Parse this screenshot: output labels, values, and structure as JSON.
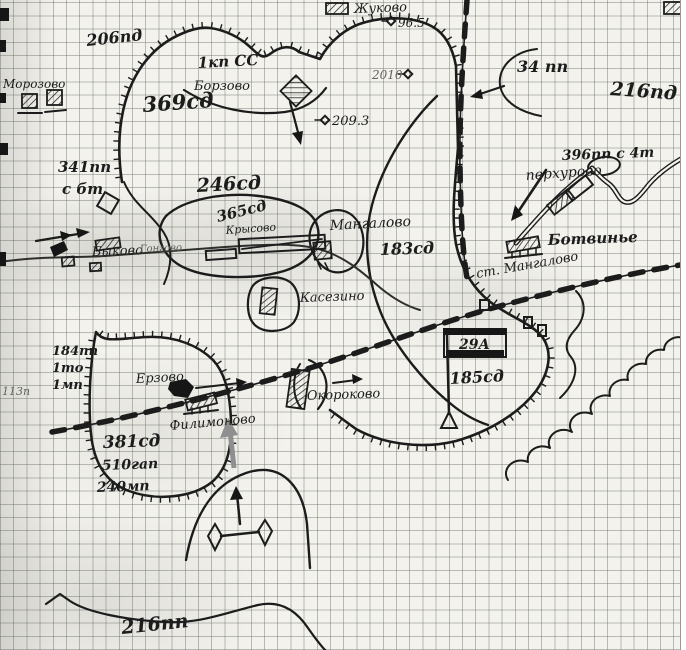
{
  "units": {
    "pd206": "206пд",
    "kpss1": "1кп СС",
    "sd369": "369сд",
    "pp34": "34 пп",
    "pd216": "216пд",
    "pp396": "396пп с 4т",
    "pp341": "341пп",
    "sbt": "с бт",
    "sd246": "246сд",
    "sd365": "365сд",
    "sd183": "183сд",
    "pp184": "184пп",
    "to1": "1то",
    "mp1": "1мп",
    "p113": "113п",
    "sd381": "381сд",
    "gap510": "510гап",
    "mp240": "240мп",
    "a29": "29А",
    "sd185": "185сд",
    "pp216": "216пп"
  },
  "places": {
    "morozovo": "Морозово",
    "zhukovo": "Жуково",
    "borzovo": "Борзово",
    "bykovo": "Быково",
    "gongovo": "Гонгово",
    "krysovo": "Крысово",
    "mangalovo": "Мангалово",
    "kasezino": "Касезино",
    "perkhurovo": "перхурово",
    "botvinye": "Ботвинье",
    "st_mangalovo": "ст. Мангалово",
    "erzovo": "Ерзово",
    "filimonovo": "Филимоново",
    "okorokovo": "Окороково"
  },
  "heights": {
    "h96_5": "96.5",
    "h2010": "2010",
    "h209_3": "209.3"
  },
  "colors": {
    "ink": "#1c1c1c",
    "paper": "#f3f2ed",
    "grid": "#9aa394",
    "faded_ink": "#63635e",
    "pencil_grey": "#8f8f8f"
  }
}
